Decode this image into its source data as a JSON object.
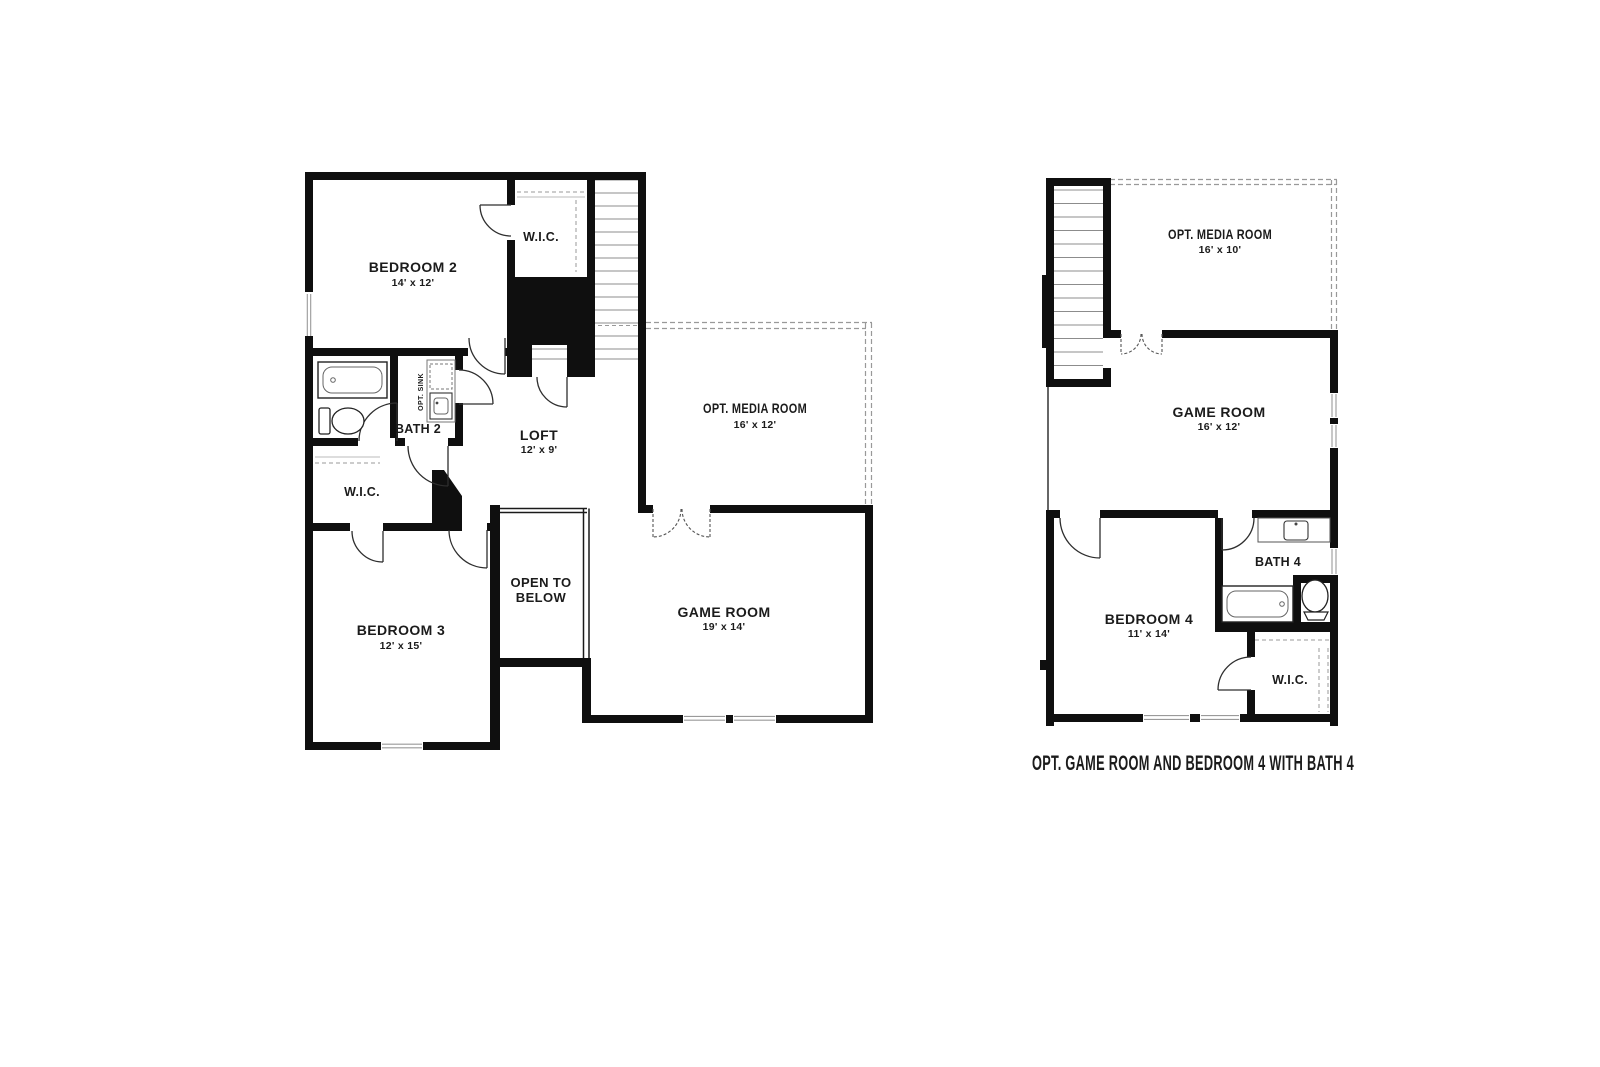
{
  "colors": {
    "wall": "#0f0f0f",
    "thin_line": "#8c8c8c",
    "dash_line": "#999999",
    "door_line": "#2e2e2e",
    "text": "#1b1b1b",
    "background": "#ffffff"
  },
  "main_plan": {
    "bedroom2_label": "BEDROOM 2",
    "bedroom2_dims": "14' x 12'",
    "wic_top_label": "W.I.C.",
    "bath2_label": "BATH 2",
    "opt_sink_label": "OPT. SINK",
    "wic2_label": "W.I.C.",
    "loft_label": "LOFT",
    "loft_dims": "12' x 9'",
    "media_label": "OPT. MEDIA ROOM",
    "media_dims": "16' x 12'",
    "open_below_line1": "OPEN TO",
    "open_below_line2": "BELOW",
    "bedroom3_label": "BEDROOM 3",
    "bedroom3_dims": "12' x 15'",
    "gameroom_label": "GAME ROOM",
    "gameroom_dims": "19' x 14'"
  },
  "option_plan": {
    "media_label": "OPT. MEDIA ROOM",
    "media_dims": "16' x 10'",
    "gameroom_label": "GAME ROOM",
    "gameroom_dims": "16' x 12'",
    "bath4_label": "BATH 4",
    "bedroom4_label": "BEDROOM 4",
    "bedroom4_dims": "11' x 14'",
    "wic_label": "W.I.C.",
    "caption": "OPT. GAME ROOM AND BEDROOM 4 WITH BATH 4"
  }
}
